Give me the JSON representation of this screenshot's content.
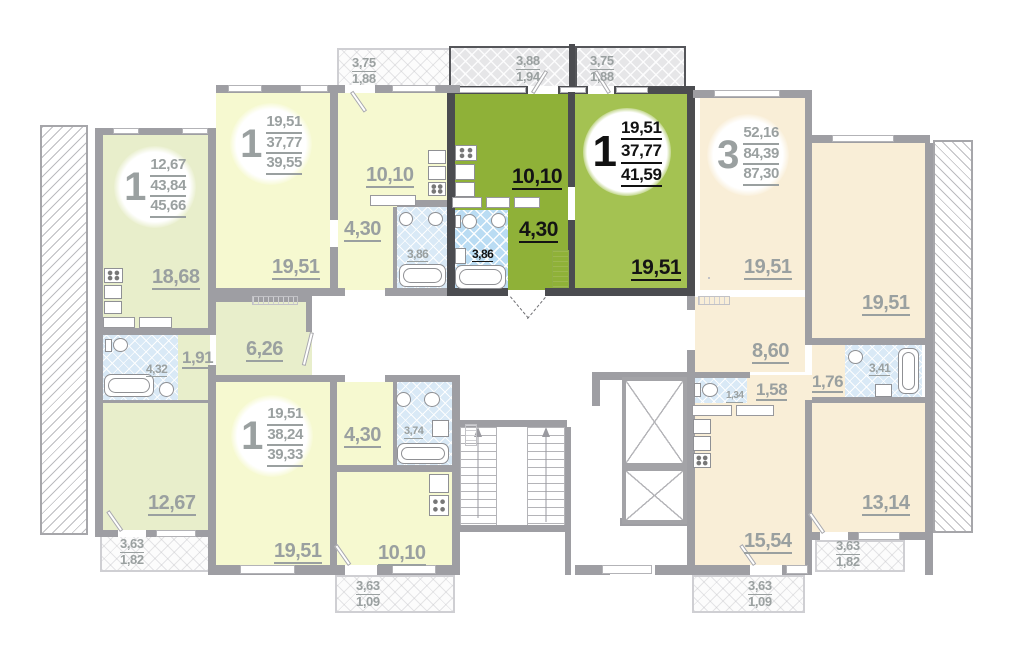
{
  "colors": {
    "highlight_kitchen": "#8FB138",
    "highlight_room": "#A4C252",
    "highlight_wall": "#4B4C50",
    "faded_left": "#E8EECB",
    "faded_yellow": "#F6F9D0",
    "faded_cream": "#F9EED7",
    "bathroom_blue": "#BADCF3",
    "wall_gray": "#9E9EA3",
    "label_gray": "#9AA0A0"
  },
  "apartments": {
    "left": {
      "badge": {
        "rooms": "1",
        "values": [
          "12,67",
          "43,84",
          "45,66"
        ]
      },
      "rooms": {
        "living": "18,68",
        "bath": "4,32",
        "hall": "1,91",
        "corridor": "6,26",
        "bedroom": "12,67"
      },
      "balcony": [
        "3,63",
        "1,82"
      ]
    },
    "top_middle": {
      "badge": {
        "rooms": "1",
        "values": [
          "19,51",
          "37,77",
          "39,55"
        ]
      },
      "rooms": {
        "living": "19,51",
        "kitchen": "10,10",
        "hall": "4,30",
        "bath": "3,86"
      },
      "balcony": [
        "3,75",
        "1,88"
      ]
    },
    "highlighted": {
      "badge": {
        "rooms": "1",
        "values": [
          "19,51",
          "37,77",
          "41,59"
        ]
      },
      "rooms": {
        "kitchen": "10,10",
        "hall": "4,30",
        "bath": "3,86",
        "living": "19,51"
      },
      "balcony_a": [
        "3,88",
        "1,94"
      ],
      "balcony_b": [
        "3,75",
        "1,88"
      ]
    },
    "bottom_middle": {
      "badge": {
        "rooms": "1",
        "values": [
          "19,51",
          "38,24",
          "39,33"
        ]
      },
      "rooms": {
        "living": "19,51",
        "hall": "4,30",
        "bath": "3,74",
        "kitchen": "10,10"
      },
      "balcony": [
        "3,63",
        "1,09"
      ]
    },
    "right": {
      "badge": {
        "rooms": "3",
        "values": [
          "52,16",
          "84,39",
          "87,30"
        ]
      },
      "rooms": {
        "room1": "19,51",
        "room2": "19,51",
        "corridor": "8,60",
        "wc": "1,34",
        "hall": "1,58",
        "bath": "3,41",
        "hall2": "1,76",
        "kitchen": "15,54",
        "room3": "13,14"
      },
      "balcony_kitchen": [
        "3,63",
        "1,09"
      ],
      "balcony_room": [
        "3,63",
        "1,82"
      ]
    }
  }
}
